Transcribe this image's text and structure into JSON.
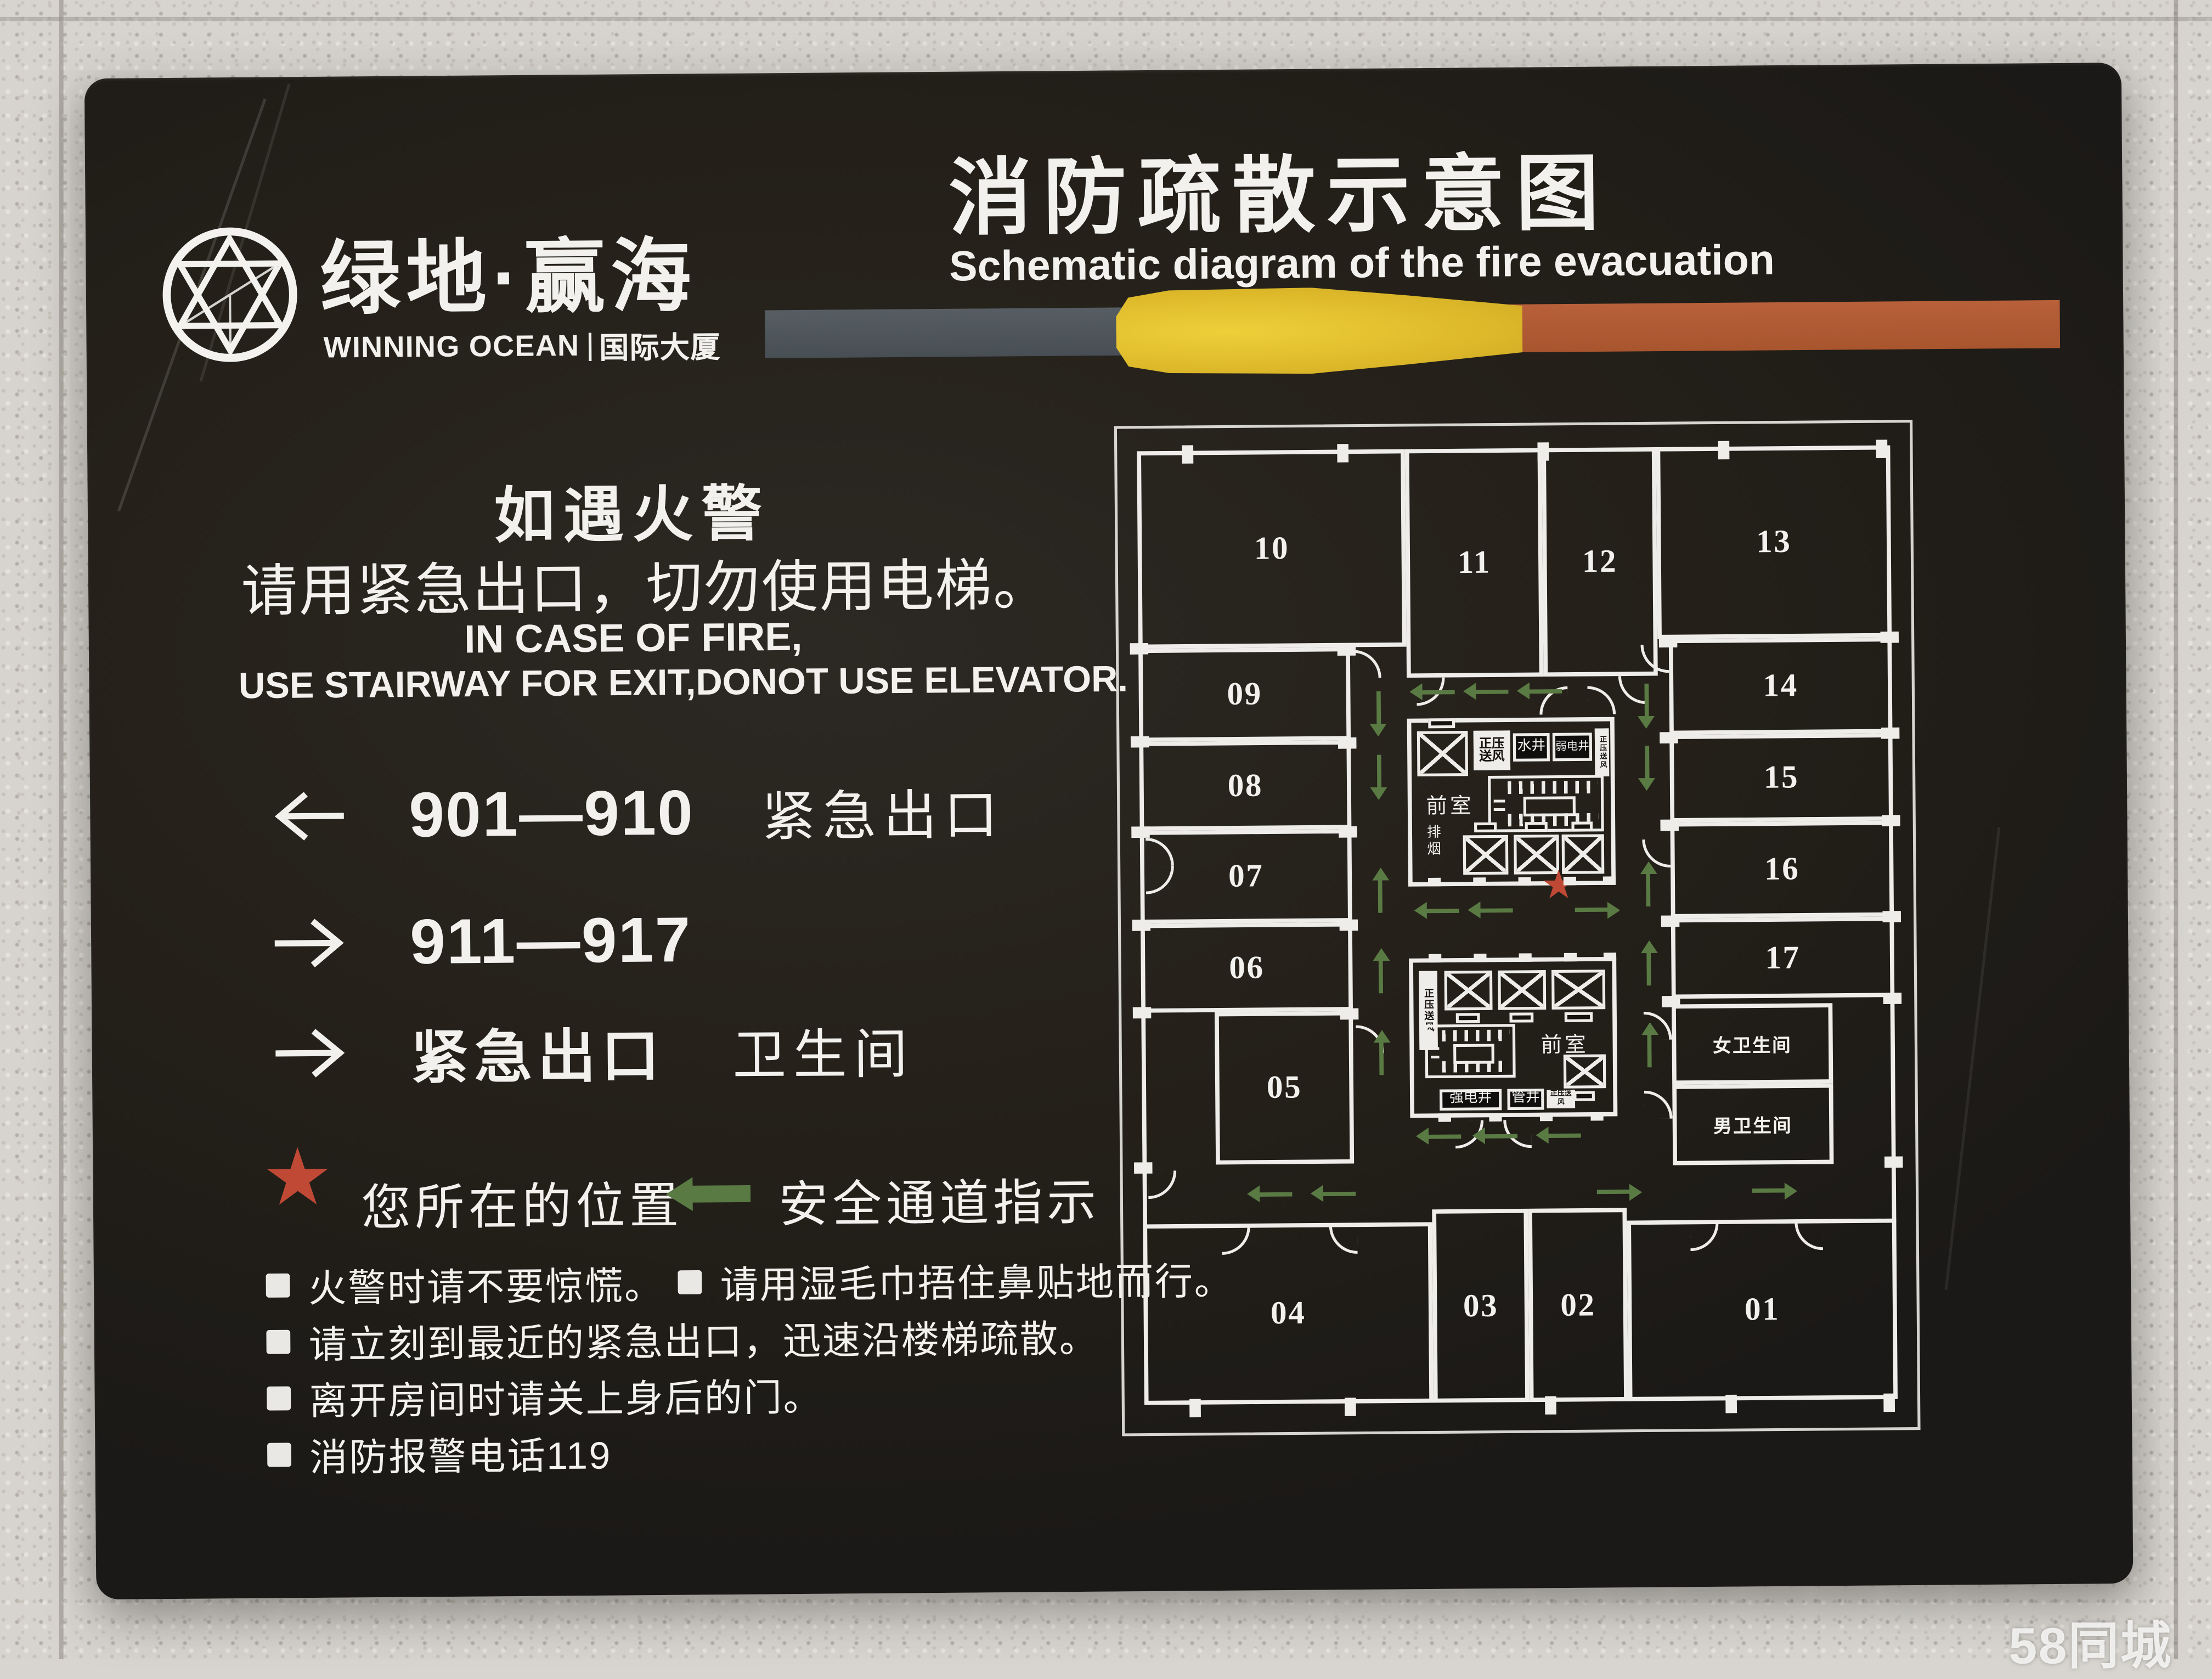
{
  "watermark": "58同城",
  "icons": {
    "star": "★"
  },
  "logo": {
    "cn": "绿地·赢海",
    "en": "WINNING OCEAN",
    "en_suffix": "国际大厦"
  },
  "title": {
    "cn": "消防疏散示意图",
    "en": "Schematic diagram of the fire evacuation"
  },
  "notice": {
    "cn1": "如遇火警",
    "cn2": "请用紧急出口，切勿使用电梯。",
    "en1": "IN CASE OF FIRE,",
    "en2": "USE STAIRWAY FOR EXIT,DONOT USE ELEVATOR."
  },
  "directions": [
    {
      "dir": "left",
      "range": "901—910",
      "label": "紧急出口"
    },
    {
      "dir": "right",
      "range": "911—917",
      "label": ""
    },
    {
      "dir": "right",
      "range": "紧急出口",
      "label": "卫生间"
    }
  ],
  "legend": {
    "star": "您所在的位置",
    "route": "安全通道指示"
  },
  "tips": [
    [
      "火警时请不要惊慌。",
      "请用湿毛巾捂住鼻贴地而行。"
    ],
    [
      "请立刻到最近的紧急出口，迅速沿楼梯疏散。"
    ],
    [
      "离开房间时请关上身后的门。"
    ],
    [
      "消防报警电话119"
    ]
  ],
  "plan": {
    "rooms": {
      "r01": "01",
      "r02": "02",
      "r03": "03",
      "r04": "04",
      "r05": "05",
      "r06": "06",
      "r07": "07",
      "r08": "08",
      "r09": "09",
      "r10": "10",
      "r11": "11",
      "r12": "12",
      "r13": "13",
      "r14": "14",
      "r15": "15",
      "r16": "16",
      "r17": "17"
    },
    "labels": {
      "front_room": "前室",
      "water_shaft": "水井",
      "weak_power_shaft": "弱电井",
      "strong_power_shaft": "强电井",
      "pipe_shaft": "管井",
      "smoke_exhaust": "排烟",
      "pressure_air": "正压送风",
      "wc_women": "女卫生间",
      "wc_men": "男卫生间"
    }
  },
  "colors": {
    "panel": "#242019",
    "wall": "#efedea",
    "star_red": "#c04936",
    "route_green": "#5a7a44",
    "bar_gray": "#4f565c",
    "bar_yellow": "#ddb92a",
    "bar_orange": "#b25c33"
  }
}
